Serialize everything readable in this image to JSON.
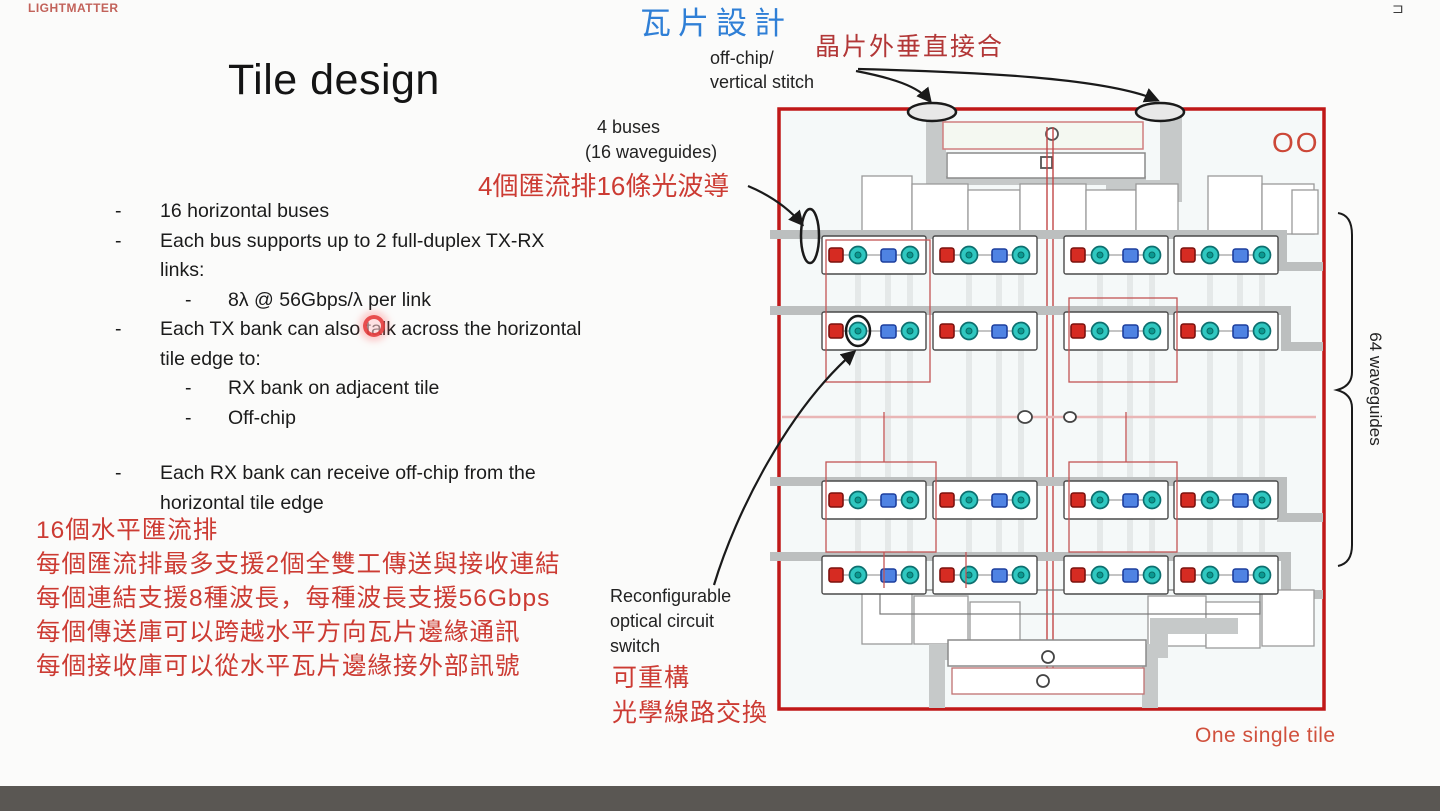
{
  "logo": "LIGHTMATTER",
  "corner_glyph": "⊐",
  "title": "Tile design",
  "zh_title": "瓦片設計",
  "labels": {
    "vertical_stitch_zh": "晶片外垂直接合",
    "off_chip": [
      "off-chip/",
      "vertical stitch"
    ],
    "buses": [
      "4 buses",
      "(16 waveguides)"
    ],
    "buses_zh": "4個匯流排16條光波導",
    "switch": [
      "Reconfigurable",
      "optical circuit",
      "switch"
    ],
    "switch_zh": [
      "可重構",
      "光學線路交換"
    ],
    "waveguides_64": "64 waveguides",
    "tile_caption": "One single tile",
    "tile_corner": "OO"
  },
  "bullets": [
    {
      "level": 1,
      "lines": [
        "16 horizontal buses"
      ]
    },
    {
      "level": 1,
      "lines": [
        "Each bus supports up to 2 full-duplex TX-RX",
        "links:"
      ]
    },
    {
      "level": 2,
      "lines": [
        "8λ @ 56Gbps/λ per link"
      ]
    },
    {
      "level": 1,
      "lines": [
        "Each TX bank can also talk across the horizontal",
        "tile edge to:"
      ]
    },
    {
      "level": 2,
      "lines": [
        "RX bank on adjacent tile"
      ]
    },
    {
      "level": 2,
      "lines": [
        "Off-chip"
      ]
    },
    {
      "level": 1,
      "spaced": true,
      "lines": [
        "Each RX bank can receive off-chip from the",
        "horizontal tile edge"
      ]
    }
  ],
  "notes_zh": [
    "16個水平匯流排",
    "每個匯流排最多支援2個全雙工傳送與接收連結",
    "每個連結支援8種波長，每種波長支援56Gbps",
    "每個傳送庫可以跨越水平方向瓦片邊緣通訊",
    "每個接收庫可以從水平瓦片邊緣接外部訊號"
  ],
  "colors": {
    "note_red": "#cc3b33",
    "zh_blue": "#2f7fd6",
    "tile_border": "#c01818",
    "bus_gray": "#bcbfbf",
    "comp_red": "#d62b22",
    "comp_teal": "#2fc7c0",
    "comp_blue": "#4f83e3",
    "caption_red": "#d0503c"
  },
  "diagram": {
    "row_y": [
      255,
      331,
      500,
      575
    ],
    "group_x": [
      836,
      947,
      1078,
      1188
    ],
    "item_dx": [
      0,
      22,
      52,
      74
    ],
    "pattern": [
      "red-square",
      "teal-ring",
      "blue-square",
      "teal-ring"
    ]
  }
}
